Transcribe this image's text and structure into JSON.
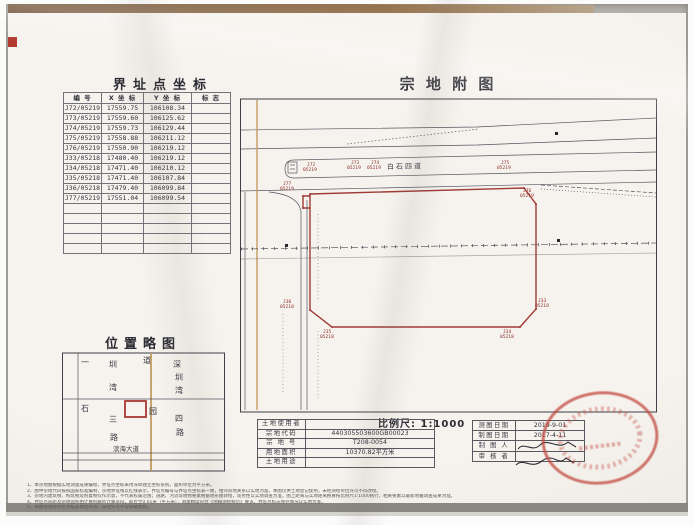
{
  "colors": {
    "boundary_red": "#a03a34",
    "seal_red": "#c24a3f",
    "road_tan": "#bd9759",
    "ink": "#33333d"
  },
  "coordinate_table": {
    "title": "界址点坐标",
    "headers": [
      "编  号",
      "X 坐 标",
      "Y 坐 标",
      "标  志"
    ],
    "rows": [
      [
        "J72/05219",
        "17559.75",
        "106108.34"
      ],
      [
        "J73/05219",
        "17559.60",
        "106125.62"
      ],
      [
        "J74/05219",
        "17559.73",
        "106129.44"
      ],
      [
        "J75/05219",
        "17558.88",
        "106211.12"
      ],
      [
        "J76/05219",
        "17550.90",
        "106219.12"
      ],
      [
        "J33/05218",
        "17480.40",
        "106219.12"
      ],
      [
        "J34/05218",
        "17471.40",
        "106210.12"
      ],
      [
        "J35/05218",
        "17471.40",
        "106107.84"
      ],
      [
        "J36/05218",
        "17479.40",
        "106099.84"
      ],
      [
        "J77/05219",
        "17551.04",
        "106099.54"
      ]
    ]
  },
  "location_sketch": {
    "title": "位置略图",
    "labels": [
      "一",
      "圳",
      "湾",
      "道",
      "深",
      "圳",
      "湾",
      "石",
      "三",
      "路",
      "园",
      "四",
      "路"
    ],
    "bottom_road": "滨海大道"
  },
  "parcel_map": {
    "title": "宗 地 附 图",
    "road_label": "白石四道",
    "scale_label": "比例尺: 1:1000",
    "points": [
      {
        "id": "J72",
        "code": "05219"
      },
      {
        "id": "J73",
        "code": "05219"
      },
      {
        "id": "J74",
        "code": "05219"
      },
      {
        "id": "J75",
        "code": "05219"
      },
      {
        "id": "J76",
        "code": "05219"
      },
      {
        "id": "J33",
        "code": "05218"
      },
      {
        "id": "J34",
        "code": "05218"
      },
      {
        "id": "J35",
        "code": "05218"
      },
      {
        "id": "J36",
        "code": "05218"
      },
      {
        "id": "J77",
        "code": "05219"
      }
    ]
  },
  "info_table": {
    "rows": [
      {
        "label": "土地使用者",
        "value": ""
      },
      {
        "label": "宗地代码",
        "value": "440305503600GB00023"
      },
      {
        "label": "宗 地 号",
        "value": "T208-0054"
      },
      {
        "label": "用地面积",
        "value": "10370.82平方米"
      },
      {
        "label": "土地用途",
        "value": ""
      }
    ]
  },
  "review_table": {
    "rows": [
      {
        "label": "测图日期",
        "value": "2019-9-01"
      },
      {
        "label": "制图日期",
        "value": "2017-4-11"
      },
      {
        "label": "制 图 人",
        "value": ""
      },
      {
        "label": "审 核 者",
        "value": ""
      }
    ]
  },
  "notes": [
    "1、本宗地图根据实地测量成果编绘，界址点坐标采用深圳独立坐标系统，面积单位为平方米。",
    "2、图中宗地代码按照国家标准编制，宗地界址线以红线表示，界址点编号与界址点坐标表一致，相邻宗地关系以实地为准，本图仅供土地登记使用，未经测绘单位许可不得改绘。",
    "3、宗地内建筑物、构筑物及附着物仅作示意，不代表权属范围；道路、河流等地物要素根据地形图转绘，现势性以实地调查为准，图上距离与实地距离换算按比例尺1:1000执行，相关要素以最新地籍调查成果为准。",
    "4、界址点间距及宗地面积由计算机解析计算求得，取位至0.01米（平方米），测量精度符合《地籍测绘规范》要求，界址点标志保存情况以实地为准。",
    "5、本图经测绘单位审核盖章后有效，未经许可不得转载复制。"
  ]
}
